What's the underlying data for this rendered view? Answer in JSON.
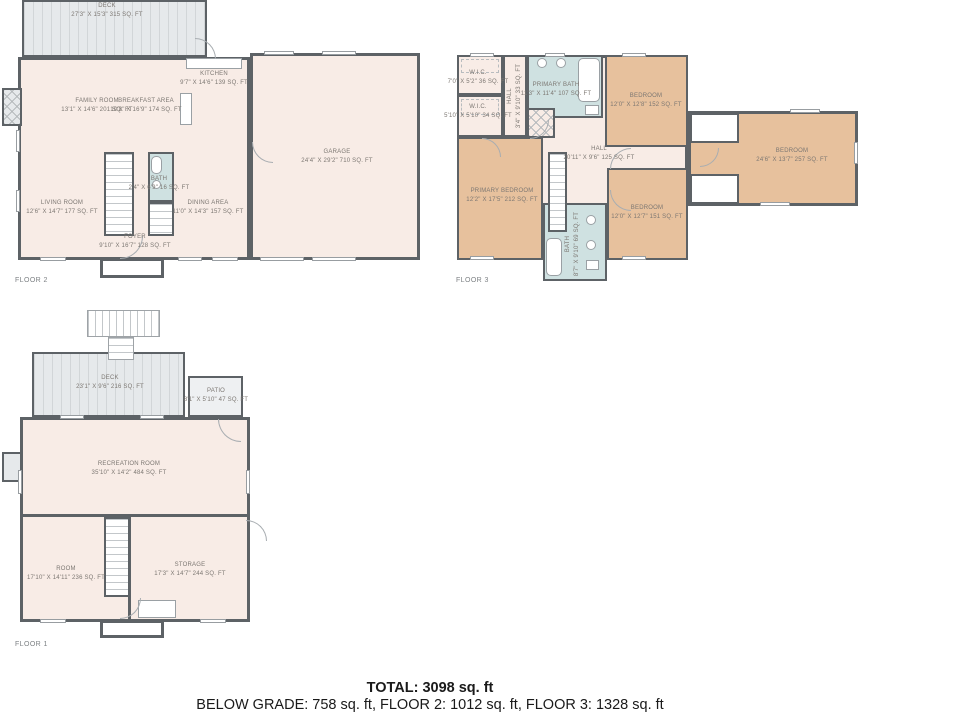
{
  "colors": {
    "wall": "#5d6266",
    "room": "#f8ece6",
    "bedroom": "#e7c19d",
    "bathroom": "#cfe1e1",
    "deck": "#e6e9eb",
    "patio": "#eef0f2",
    "labeltext": "#7c7772",
    "captiontext": "#7d8184",
    "summarytext": "#1a1a1a"
  },
  "floors": [
    {
      "caption": "FLOOR 2",
      "rooms": [
        {
          "name": "DECK",
          "dims": "27'3\" X 15'3\" 315 SQ. FT"
        },
        {
          "name": "FAMILY ROOM",
          "dims": "13'1\" X 14'6\" 201 SQ. FT"
        },
        {
          "name": "BREAKFAST AREA",
          "dims": "10'8\" X 16'9\" 174 SQ. FT"
        },
        {
          "name": "KITCHEN",
          "dims": "9'7\" X 14'6\" 139 SQ. FT"
        },
        {
          "name": "GARAGE",
          "dims": "24'4\" X 29'2\" 710 SQ. FT"
        },
        {
          "name": "LIVING ROOM",
          "dims": "12'6\" X 14'7\" 177 SQ. FT"
        },
        {
          "name": "BATH",
          "dims": "2'4\" X 6'9\" 16 SQ. FT"
        },
        {
          "name": "DINING AREA",
          "dims": "11'0\" X 14'3\" 157 SQ. FT"
        },
        {
          "name": "FOYER",
          "dims": "9'10\" X 16'7\" 128 SQ. FT"
        }
      ]
    },
    {
      "caption": "FLOOR 3",
      "rooms": [
        {
          "name": "W.I.C.",
          "dims": "7'0\" X 5'2\" 36 SQ. FT"
        },
        {
          "name": "W.I.C.",
          "dims": "5'10\" X 5'10\" 34 SQ. FT"
        },
        {
          "name": "HALL",
          "dims": "3'4\" X 9'10\" 33 SQ. FT"
        },
        {
          "name": "PRIMARY BATH",
          "dims": "11'3\" X 11'4\" 107 SQ. FT"
        },
        {
          "name": "BEDROOM",
          "dims": "12'0\" X 12'8\" 152 SQ. FT"
        },
        {
          "name": "BEDROOM",
          "dims": "24'6\" X 13'7\" 257 SQ. FT"
        },
        {
          "name": "HALL",
          "dims": "20'11\" X 9'6\" 125 SQ. FT"
        },
        {
          "name": "PRIMARY BEDROOM",
          "dims": "12'2\" X 17'5\" 212 SQ. FT"
        },
        {
          "name": "BATH",
          "dims": "8'7\" X 9'10\" 69 SQ. FT"
        },
        {
          "name": "BEDROOM",
          "dims": "12'0\" X 12'7\" 151 SQ. FT"
        }
      ]
    },
    {
      "caption": "FLOOR 1",
      "rooms": [
        {
          "name": "DECK",
          "dims": "23'1\" X 9'6\" 216 SQ. FT"
        },
        {
          "name": "PATIO",
          "dims": "8'1\" X 5'10\" 47 SQ. FT"
        },
        {
          "name": "RECREATION ROOM",
          "dims": "35'10\" X 14'2\" 484 SQ. FT"
        },
        {
          "name": "ROOM",
          "dims": "17'10\" X 14'11\" 236 SQ. FT"
        },
        {
          "name": "STORAGE",
          "dims": "17'3\" X 14'7\" 244 SQ. FT"
        }
      ]
    }
  ],
  "summary": {
    "total": "TOTAL: 3098 sq. ft",
    "breakdown": "BELOW GRADE: 758 sq. ft, FLOOR 2: 1012 sq. ft, FLOOR 3: 1328 sq. ft"
  }
}
